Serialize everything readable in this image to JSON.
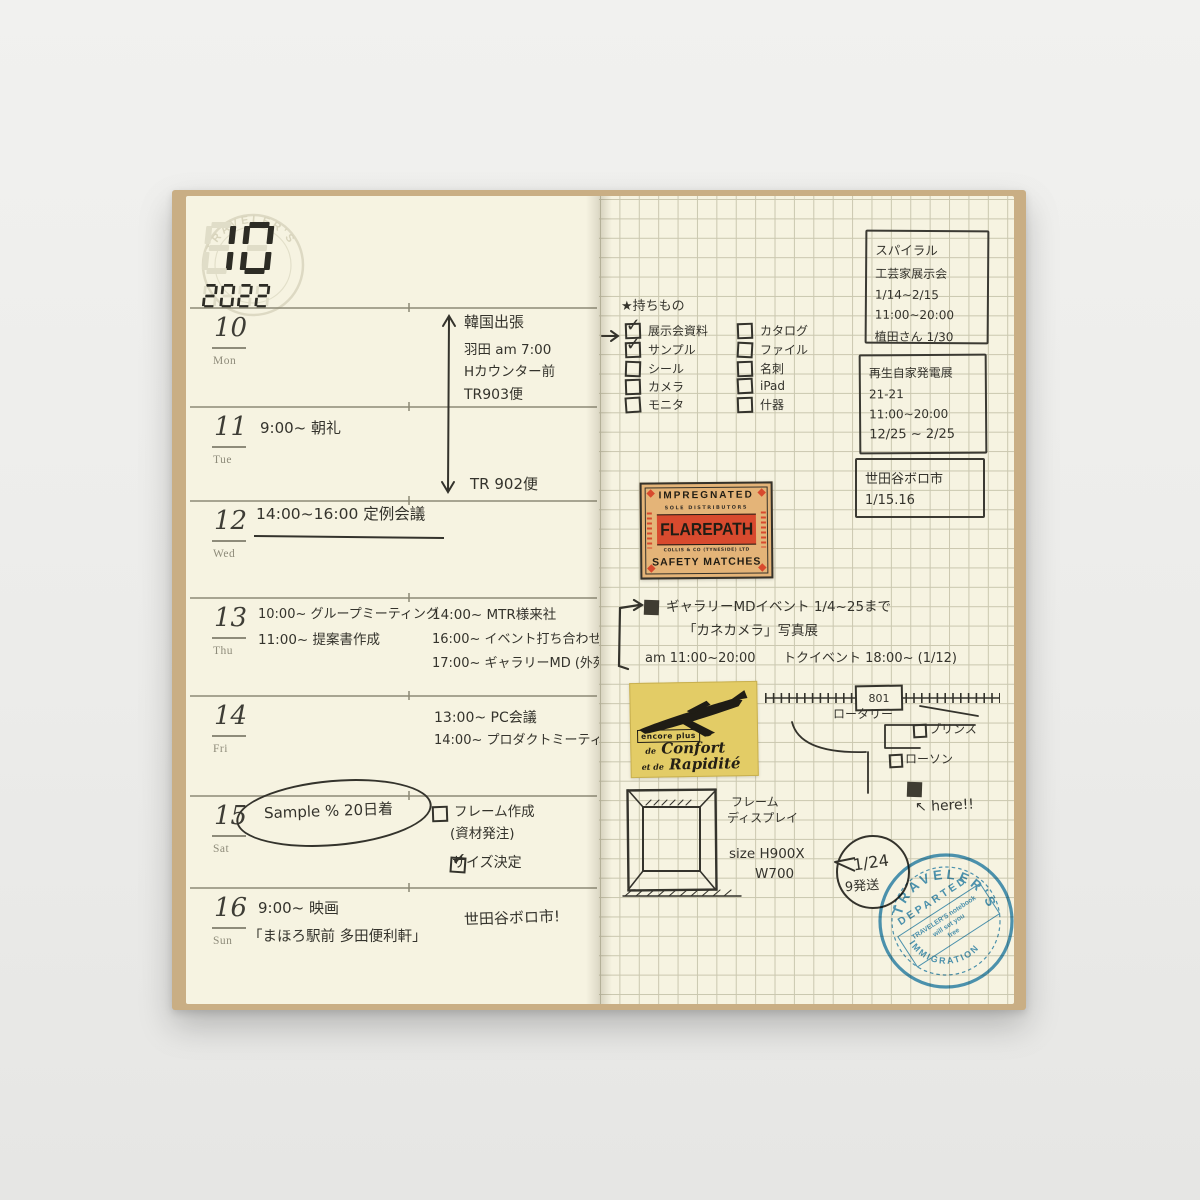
{
  "colors": {
    "page": "#f6f3e1",
    "grid_line": "#cac7af",
    "rule_line": "#8c8a76",
    "ink": "#34332c",
    "match_bg": "#e4b478",
    "match_red": "#d84a2e",
    "plane_bg": "#e3cc66",
    "stamp_blue": "#3a8dbd",
    "cover_tan": "#c9ae84"
  },
  "notebook": {
    "month": "10",
    "year": "2022",
    "watermark_text": "TRAVELER'S"
  },
  "left_page": {
    "days": [
      {
        "date": "10",
        "weekday": "Mon"
      },
      {
        "date": "11",
        "weekday": "Tue",
        "entry": "9:00~ 朝礼"
      },
      {
        "date": "12",
        "weekday": "Wed",
        "entry": "14:00~16:00 定例会議"
      },
      {
        "date": "13",
        "weekday": "Thu",
        "morning": [
          "10:00~ グループミーティング",
          "11:00~ 提案書作成"
        ],
        "afternoon": [
          "14:00~ MTR様来社",
          "16:00~ イベント打ち合わせ",
          "17:00~ ギャラリーMD (外苑)"
        ]
      },
      {
        "date": "14",
        "weekday": "Fri",
        "afternoon": [
          "13:00~ PC会議",
          "14:00~ プロダクトミーティング"
        ]
      },
      {
        "date": "15",
        "weekday": "Sat",
        "circled_note": "Sample % 20日着",
        "task1": "フレーム作成",
        "task1_sub": "(資材発注)",
        "task2": "サイズ決定"
      },
      {
        "date": "16",
        "weekday": "Sun",
        "entry": "9:00~ 映画",
        "entry2": "「まほろ駅前 多田便利軒」",
        "side_note": "世田谷ボロ市!"
      }
    ],
    "trip": {
      "title": "韓国出張",
      "detail1": "羽田 am 7:00",
      "detail2": "Hカウンター前",
      "detail3": "TR903便",
      "return_flight": "TR 902便"
    }
  },
  "right_page": {
    "packing_list": {
      "header": "★持ちもの",
      "col1": [
        {
          "label": "展示会資料",
          "checked": true
        },
        {
          "label": "サンプル",
          "checked": true
        },
        {
          "label": "シール",
          "checked": false
        },
        {
          "label": "カメラ",
          "checked": false
        },
        {
          "label": "モニタ",
          "checked": false
        }
      ],
      "col2": [
        {
          "label": "カタログ",
          "checked": false
        },
        {
          "label": "ファイル",
          "checked": false
        },
        {
          "label": "名刺",
          "checked": false
        },
        {
          "label": "iPad",
          "checked": false
        },
        {
          "label": "什器",
          "checked": false
        }
      ]
    },
    "note_box_1": {
      "line1": "スパイラル",
      "line2": "工芸家展示会",
      "line3": "1/14~2/15",
      "line4": "11:00~20:00",
      "line5": "植田さん 1/30"
    },
    "note_box_2": {
      "line1": "再生自家発電展",
      "line2": "21-21",
      "line3": "11:00~20:00",
      "line4": "12/25 ~ 2/25"
    },
    "note_box_3": {
      "line1": "世田谷ボロ市",
      "line2": "1/15.16"
    },
    "matchbox_sticker": {
      "top": "IMPREGNATED",
      "sub": "SOLE DISTRIBUTORS",
      "brand": "FLAREPATH",
      "maker": "COLLIS & CO (TYNESIDE) LTD",
      "bottom": "SAFETY MATCHES"
    },
    "gallery_event": {
      "line1": "ギャラリーMDイベント 1/4~25まで",
      "line2": "「カネカメラ」写真展",
      "line3a": "am 11:00~20:00",
      "line3b": "トクイベント 18:00~ (1/12)"
    },
    "airplane_sticker": {
      "tag": "encore plus",
      "script_small1": "de",
      "script1": "Confort",
      "script_small2": "et de",
      "script2": "Rapidité"
    },
    "map": {
      "station_label": "801",
      "rotary_label": "ロータリー",
      "poi1": "プリンス",
      "poi2": "ローソン",
      "here_label": "↖ here!!"
    },
    "frame_sketch": {
      "label_line1": "フレーム",
      "label_line2": "ディスプレイ",
      "size_line1": "size H900X",
      "size_line2": "W700",
      "bubble_line1": "1/24",
      "bubble_line2": "9発送"
    },
    "stamp": {
      "arc_top": "TRAVELER'S",
      "diagonal": "DEPARTED",
      "inner_line1": "TRAVELER'S notebook",
      "inner_line2": "will set you",
      "inner_line3": "free",
      "arc_bottom": "IMMIGRATION"
    }
  }
}
